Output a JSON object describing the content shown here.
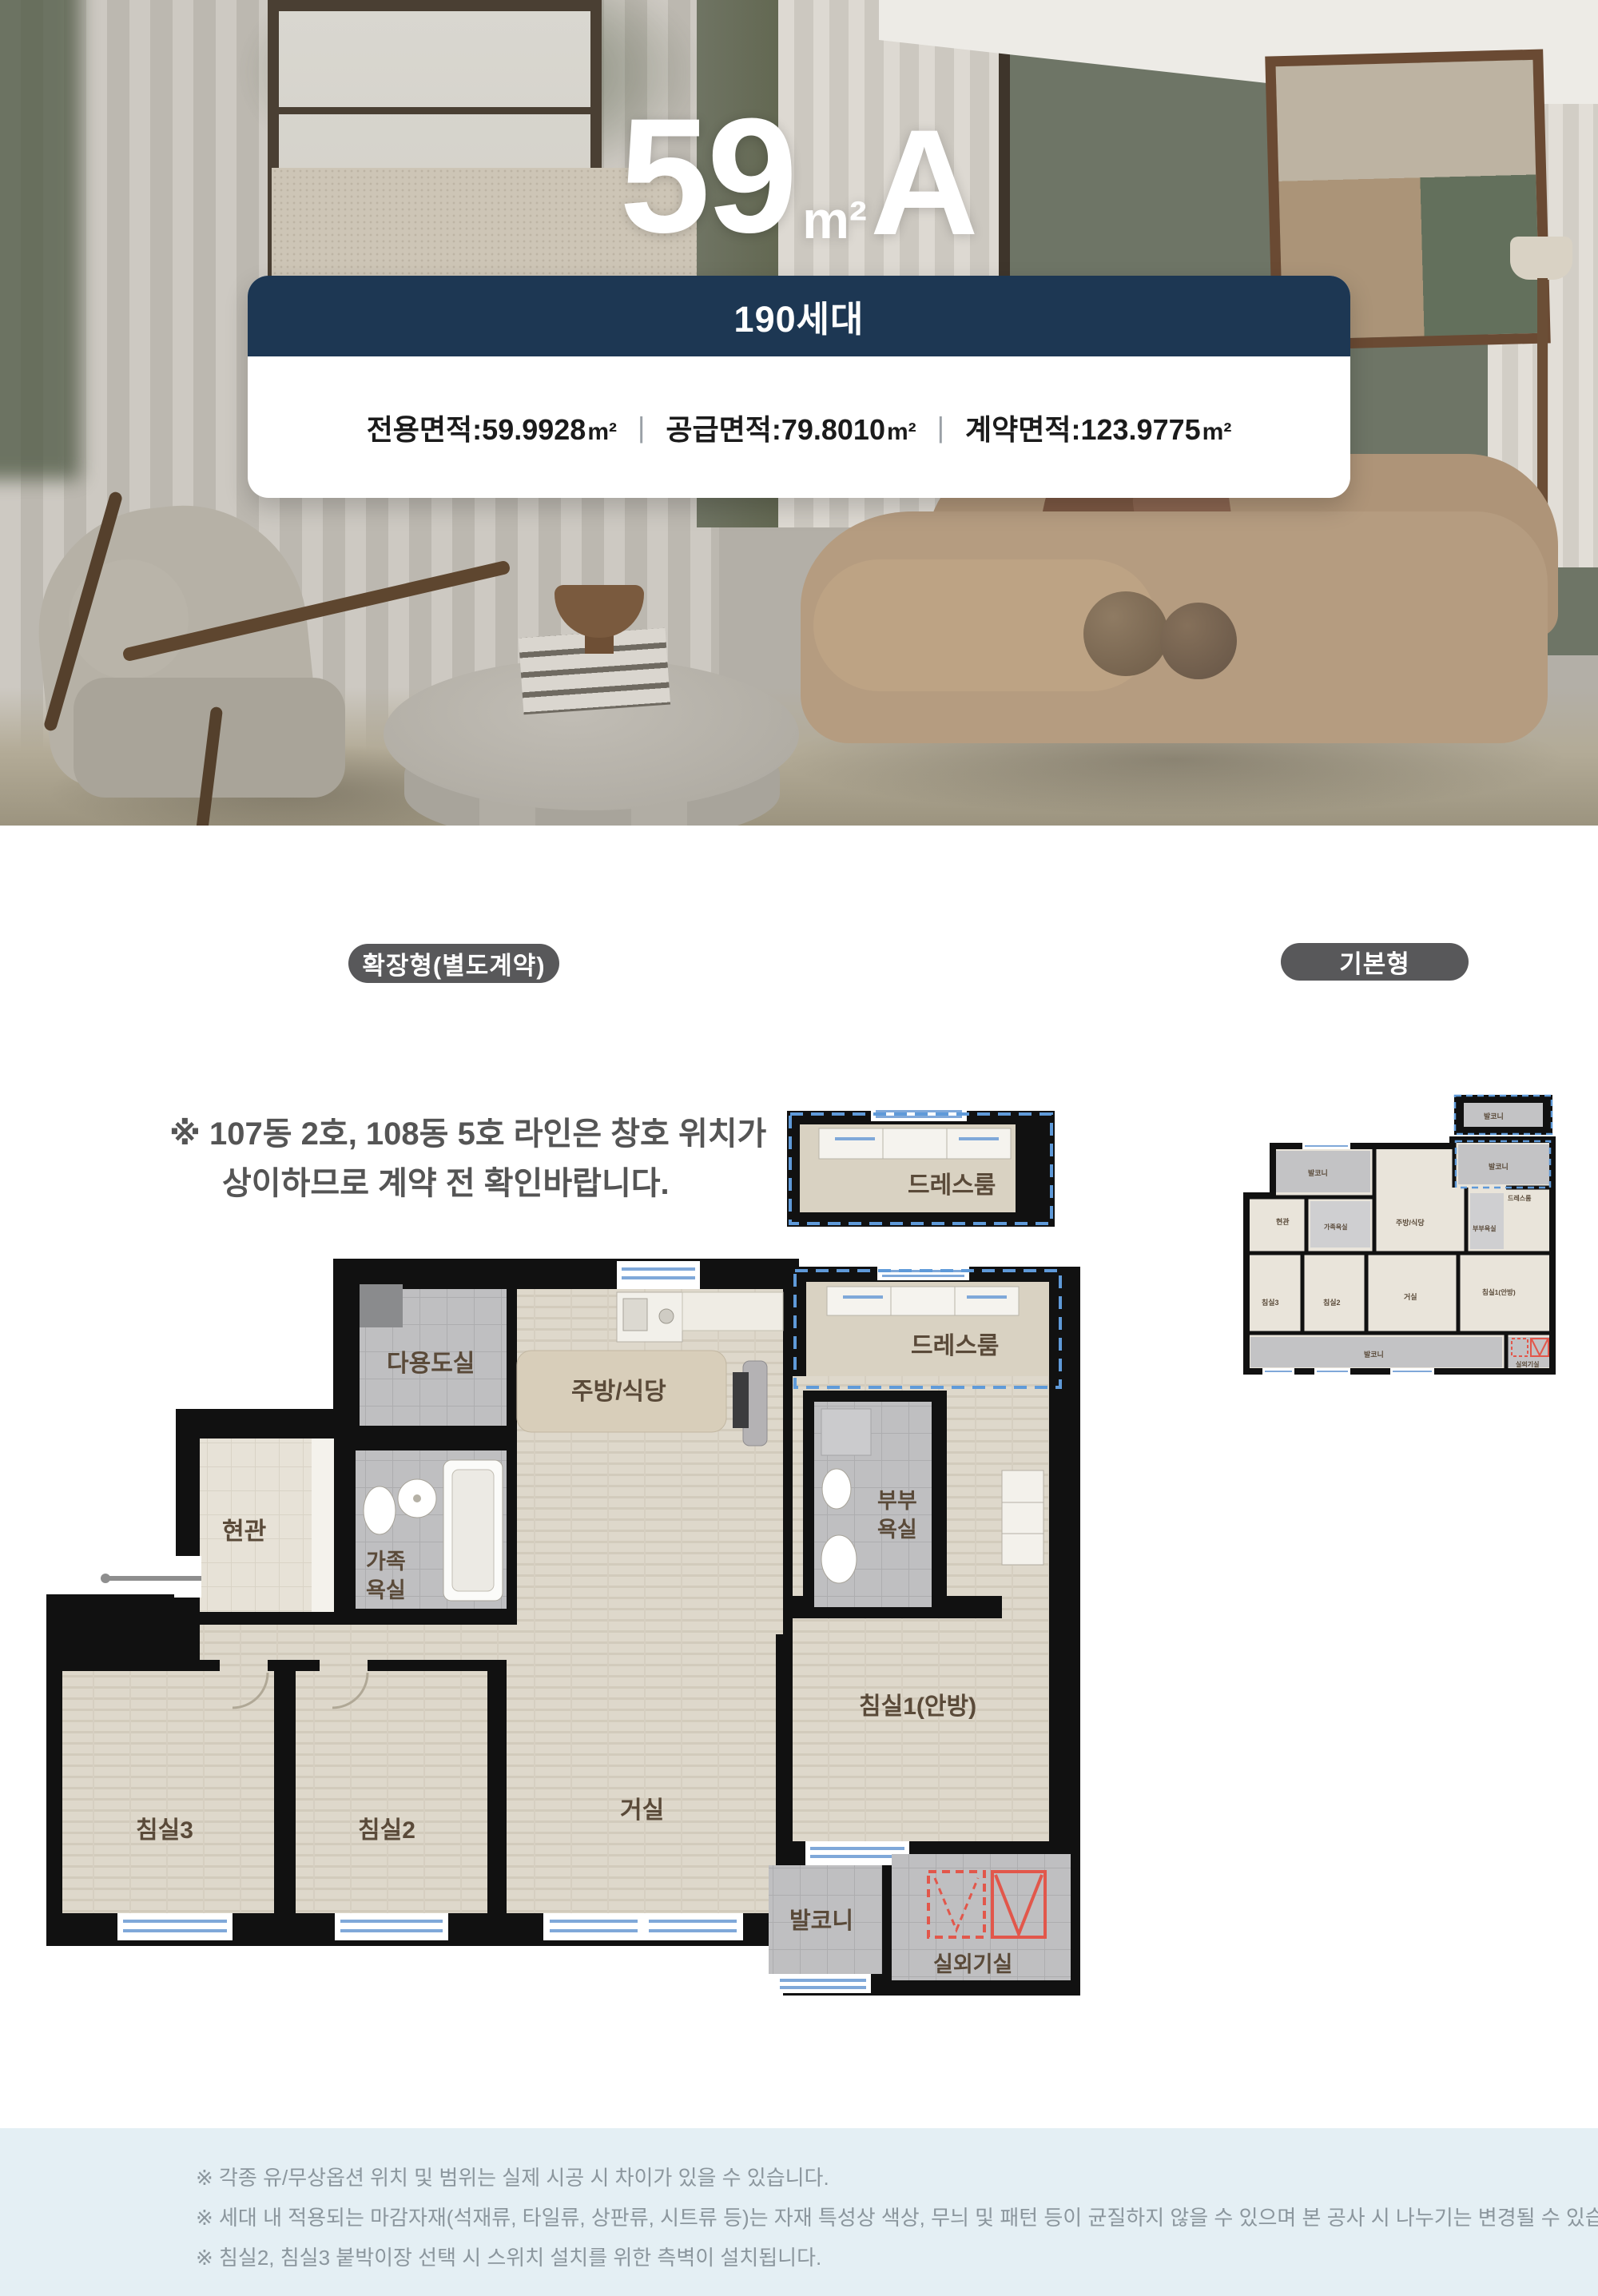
{
  "hero": {
    "title_num": "59",
    "title_unit": "m²",
    "title_type": "A",
    "badge": "190세대",
    "colon": " : ",
    "areas": [
      {
        "label": "전용면적",
        "value": "59.9928",
        "unit": "m²"
      },
      {
        "label": "공급면적",
        "value": "79.8010",
        "unit": "m²"
      },
      {
        "label": "계약면적",
        "value": "123.9775",
        "unit": "m²"
      }
    ],
    "separator": "|"
  },
  "tabs": {
    "extended": "확장형(별도계약)",
    "basic": "기본형"
  },
  "note": {
    "line1": "※ 107동 2호, 108동 5호 라인은 창호 위치가",
    "line2": "상이하므로 계약 전 확인바랍니다."
  },
  "main_plan": {
    "dress1": "드레스룸",
    "dress2": "드레스룸",
    "utility": "다용도실",
    "kitchen": "주방/식당",
    "entrance": "현관",
    "family_bath_l1": "가족",
    "family_bath_l2": "욕실",
    "master_bath_l1": "부부",
    "master_bath_l2": "욕실",
    "bed1": "침실1(안방)",
    "bed2": "침실2",
    "bed3": "침실3",
    "living": "거실",
    "balcony": "발코니",
    "ac_room": "실외기실"
  },
  "mini_plan": {
    "balcony_top": "발코니",
    "balcony_right": "발코니",
    "balcony_detached": "발코니",
    "dress": "드레스룸",
    "entrance": "현관",
    "family_bath": "가족욕실",
    "kitchen": "주방/식당",
    "master_bath": "부부욕실",
    "bed3": "침실3",
    "bed2": "침실2",
    "living": "거실",
    "bed1": "침실1(안방)",
    "balcony_bottom": "발코니",
    "ac_room": "실외기실"
  },
  "footer": {
    "line1": "※ 각종 유/무상옵션 위치 및 범위는 실제 시공 시 차이가 있을 수 있습니다.",
    "line2": "※ 세대 내 적용되는 마감자재(석재류, 타일류, 상판류, 시트류 등)는 자재 특성상 색상, 무늬 및 패턴 등이 균질하지 않을 수 있으며 본 공사 시 나누기는 변경될 수 있습니다.",
    "line3": "※ 침실2, 침실3 붙박이장 선택 시 스위치 설치를 위한 측벽이 설치됩니다."
  },
  "colors": {
    "navy": "#1d3753",
    "pill_gray": "#58585a",
    "label_brown": "#5a4a39",
    "window_blue": "#7fa8d9",
    "dash_blue": "#5f9ad9",
    "ac_red": "#e2574b",
    "footer_bg": "#e4eff4"
  }
}
